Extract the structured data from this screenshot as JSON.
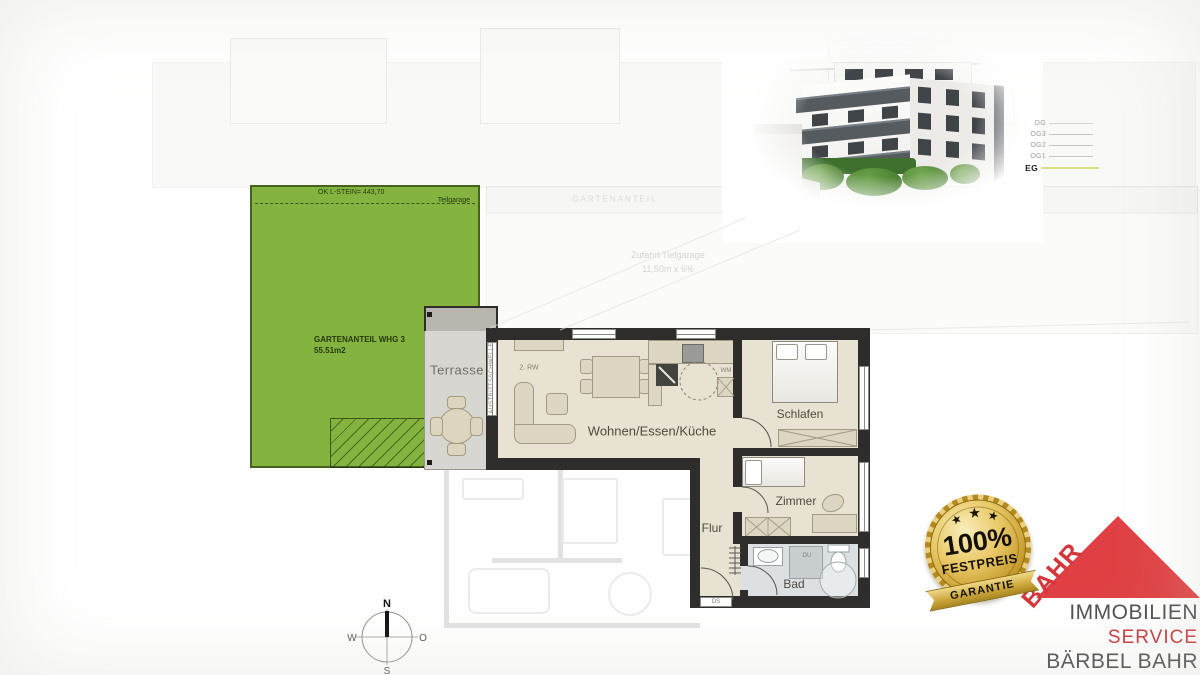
{
  "garden": {
    "top_note": "OK L-STEIN= 443,70",
    "teilgarage": "Teilgarage",
    "area1": "GARTENANTEIL WHG 3",
    "area2": "55.51m2"
  },
  "faded": {
    "band": "GARTENANTEIL",
    "ramp1": "Zufahrt Tiefgarage",
    "ramp2": "11,50m x 6%"
  },
  "rooms": {
    "terrasse": "Terrasse",
    "wohnen": "Wohnen/Essen/Küche",
    "schlafen": "Schlafen",
    "zimmer": "Zimmer",
    "flur": "Flur",
    "bad": "Bad"
  },
  "ann": {
    "rw": "2. RW",
    "schwelle": "AUSTRITTSSCHWELLE",
    "wm": "WM",
    "du": "DU",
    "ds": "DS"
  },
  "legend": {
    "floors": [
      "DG",
      "OG3",
      "OG2",
      "OG1",
      "EG"
    ],
    "active_floor": "EG"
  },
  "badge": {
    "star": "★",
    "percent": "100%",
    "name": "FESTPREIS",
    "ribbon": "GARANTIE"
  },
  "brand": {
    "name": "BAHR",
    "line1": "IMMOBILIEN",
    "line2": "SERVICE",
    "line3": "BÄRBEL BAHR"
  },
  "compass": {
    "n": "N",
    "e": "O",
    "s": "S",
    "w": "W"
  },
  "colors": {
    "garden_green": "#84b43f",
    "wall_dark": "#2e2d2b",
    "floor_beige": "#e7e2d2",
    "bath_gray": "#dce0e2",
    "brand_red": "#d4363c",
    "gold": "#d4a72c",
    "eg_line": "#d9df85"
  }
}
